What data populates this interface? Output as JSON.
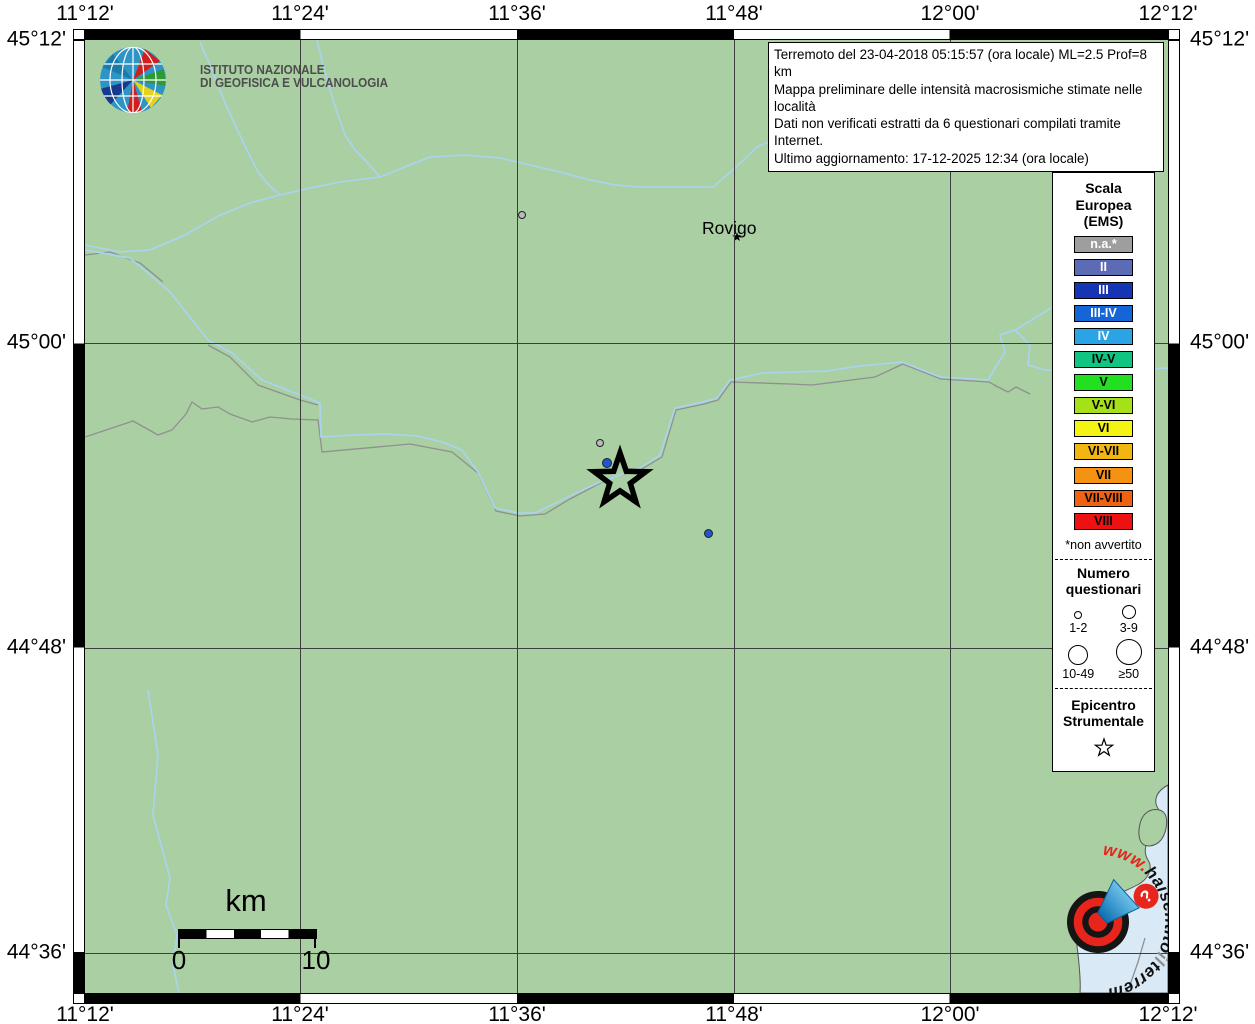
{
  "title_hint": "INGV macroseismic intensity map (haisentitoilterremoto.it)",
  "frame": {
    "top_labels": [
      "11°12'",
      "11°24'",
      "11°36'",
      "11°48'",
      "12°00'",
      "12°12'"
    ],
    "bottom_labels": [
      "11°12'",
      "11°24'",
      "11°36'",
      "11°48'",
      "12°00'",
      "12°12'"
    ],
    "left_labels": [
      "45°12'",
      "45°00'",
      "44°48'",
      "44°36'"
    ],
    "right_labels": [
      "45°12'",
      "45°00'",
      "44°48'",
      "44°36'"
    ]
  },
  "infobox": {
    "line1": "Terremoto del 23-04-2018 05:15:57 (ora locale) ML=2.5 Prof=8 km",
    "line2": "Mappa preliminare delle intensità macrosismiche stimate nelle località",
    "line3": "Dati non verificati estratti da 6 questionari compilati tramite Internet.",
    "line4": "Ultimo aggiornamento: 17-12-2025 12:34 (ora locale)"
  },
  "ingv_logo": {
    "line1": "ISTITUTO NAZIONALE",
    "line2": "DI GEOFISICA E VULCANOLOGIA"
  },
  "map": {
    "city_label": "Rovigo",
    "dots": [
      {
        "x": 437,
        "y": 175,
        "r": 4,
        "color": "#b9b9b9"
      },
      {
        "x": 515,
        "y": 403,
        "r": 4,
        "color": "#b9b9b9"
      },
      {
        "x": 522,
        "y": 423,
        "r": 5,
        "color": "#1e56d2"
      },
      {
        "x": 623,
        "y": 493,
        "r": 4.5,
        "color": "#1e56d2"
      }
    ],
    "epicenter": {
      "x": 535,
      "y": 440
    }
  },
  "scalebar": {
    "unit_label": "km",
    "tick_start": "0",
    "tick_end": "10"
  },
  "legend": {
    "title1": "Scala",
    "title2": "Europea",
    "title3": "(EMS)",
    "scale": [
      {
        "label": "n.a.*",
        "color": "#9e9e9e",
        "text": "#ffffff"
      },
      {
        "label": "II",
        "color": "#5c6cb4",
        "text": "#ffffff"
      },
      {
        "label": "III",
        "color": "#1535b4",
        "text": "#ffffff"
      },
      {
        "label": "III-IV",
        "color": "#1565d8",
        "text": "#ffffff"
      },
      {
        "label": "IV",
        "color": "#2aa4e6",
        "text": "#ffffff"
      },
      {
        "label": "IV-V",
        "color": "#10c581",
        "text": "#000000"
      },
      {
        "label": "V",
        "color": "#20e020",
        "text": "#000000"
      },
      {
        "label": "V-VI",
        "color": "#a6e018",
        "text": "#000000"
      },
      {
        "label": "VI",
        "color": "#f4f414",
        "text": "#000000"
      },
      {
        "label": "VI-VII",
        "color": "#f2b613",
        "text": "#000000"
      },
      {
        "label": "VII",
        "color": "#f59212",
        "text": "#000000"
      },
      {
        "label": "VII-VIII",
        "color": "#ee6211",
        "text": "#000000"
      },
      {
        "label": "VIII",
        "color": "#ee1111",
        "text": "#000000"
      }
    ],
    "footnote": "*non avvertito",
    "questionnaires": {
      "title1": "Numero",
      "title2": "questionari",
      "sizes": [
        {
          "label": "1-2",
          "r": 4
        },
        {
          "label": "3-9",
          "r": 7
        },
        {
          "label": "10-49",
          "r": 10
        },
        {
          "label": "≥50",
          "r": 13
        }
      ]
    },
    "epicenter_title1": "Epicentro",
    "epicenter_title2": "Strumentale"
  },
  "logo_hsit": {
    "segments": [
      {
        "text": "www.",
        "color": "#e8251d"
      },
      {
        "text": "hai",
        "color": "#111111"
      },
      {
        "text": "sentito",
        "color": "#111111"
      },
      {
        "text": "il",
        "color": "#8f8f8f"
      },
      {
        "text": "terremoto",
        "color": "#111111"
      },
      {
        "text": ".it",
        "color": "#e8251d"
      }
    ]
  },
  "colors": {
    "land": "#a9cfa2",
    "water": "#d9eaf6",
    "river": "#a9d4ea",
    "boundary": "#909090",
    "grid": "#3d3d3d"
  }
}
